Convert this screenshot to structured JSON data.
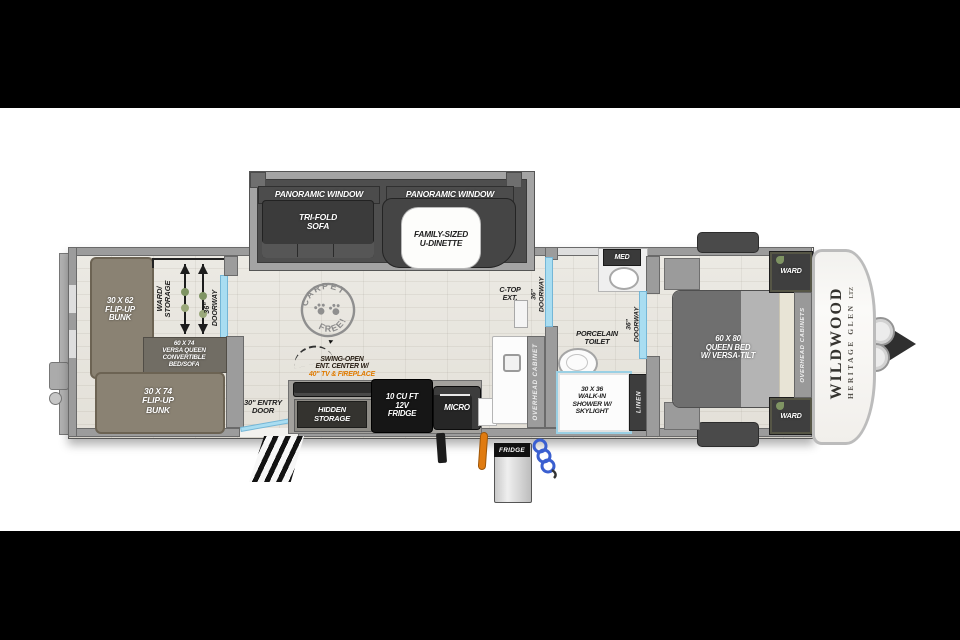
{
  "slide": {
    "panoramic_left": "PANORAMIC WINDOW",
    "panoramic_right": "PANORAMIC WINDOW",
    "sofa": "TRI-FOLD\nSOFA",
    "dinette": "FAMILY-SIZED\nU-DINETTE"
  },
  "bunks": {
    "top_bunk": "30 X 62\nFLIP-UP\nBUNK",
    "ward_storage": "WARD/\nSTORAGE",
    "doorway": "36\"\nDOORWAY",
    "versa_queen": "60 X 74\nVERSA QUEEN\nCONVERTIBLE\nBED/SOFA",
    "bottom_bunk": "30 X 74\nFLIP-UP\nBUNK"
  },
  "galley": {
    "entry_door": "30\" ENTRY\nDOOR",
    "carpet_top": "CARPET",
    "carpet_bottom": "FREE!",
    "ent_line1": "SWING-OPEN",
    "ent_line2": "ENT. CENTER W/",
    "ent_line3": "40\" TV & FIREPLACE",
    "hidden_storage": "HIDDEN\nSTORAGE",
    "fridge": "10 CU FT\n12V\nFRIDGE",
    "micro": "MICRO",
    "ctop": "C-TOP\nEXT.",
    "overhead_cabinet": "OVERHEAD CABINET",
    "doorway": "36\"\nDOORWAY"
  },
  "bath": {
    "med": "MED",
    "toilet": "PORCELAIN\nTOILET",
    "doorway": "36\"\nDOORWAY",
    "shower": "30 X 36\nWALK-IN\nSHOWER W/\nSKYLIGHT",
    "linen": "LINEN"
  },
  "bedroom": {
    "bed": "60 X 80\nQUEEN BED\nW/ VERSA-TILT",
    "ward_top": "WARD",
    "ward_bottom": "WARD",
    "overhead_cabinets": "OVERHEAD CABINETS"
  },
  "brand": {
    "name": "WILDWOOD",
    "sub": "HERITAGE GLEN",
    "trim": "LTZ"
  },
  "exterior": {
    "fridge": "FRIDGE"
  },
  "colors": {
    "letterbox": "#000000",
    "wall": "#9c9c9c",
    "floor": "#e8e5df",
    "bunk_olive": "#8a8273",
    "appliance_black": "#161616",
    "doorway_blue": "#a9ddf1",
    "accent_orange": "#e07b00",
    "ward_green": "#7f9463"
  }
}
